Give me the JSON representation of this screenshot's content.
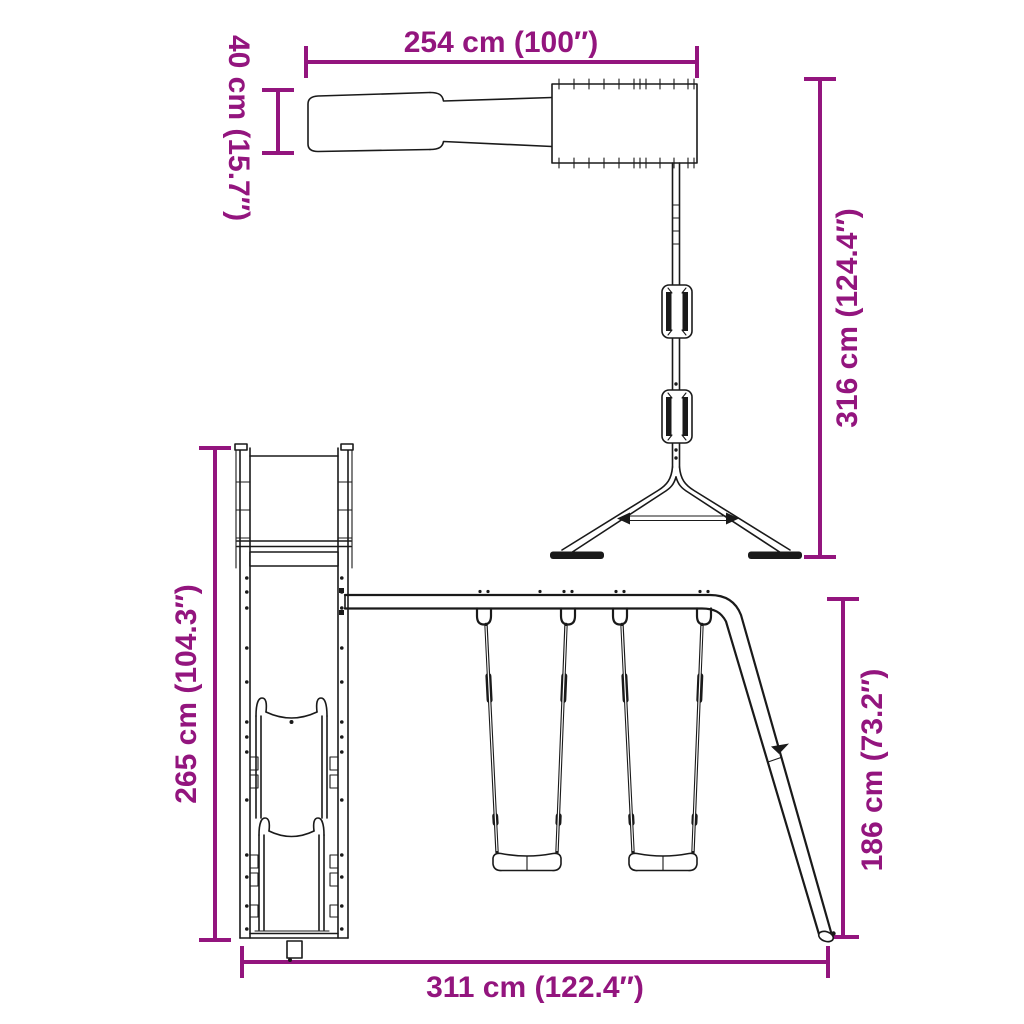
{
  "colors": {
    "dimension": "#93157E",
    "line_art": "#1A1A1A",
    "background": "#FFFFFF"
  },
  "views": {
    "top": {
      "dimensions": {
        "overall_width": "254 cm (100″)",
        "slide_width": "40 cm (15.7″)",
        "overall_depth": "316 cm (124.4″)"
      }
    },
    "front": {
      "dimensions": {
        "height": "265 cm (104.3″)",
        "swing_frame_height": "186 cm (73.2″)",
        "overall_width": "311 cm (122.4″)"
      }
    }
  }
}
